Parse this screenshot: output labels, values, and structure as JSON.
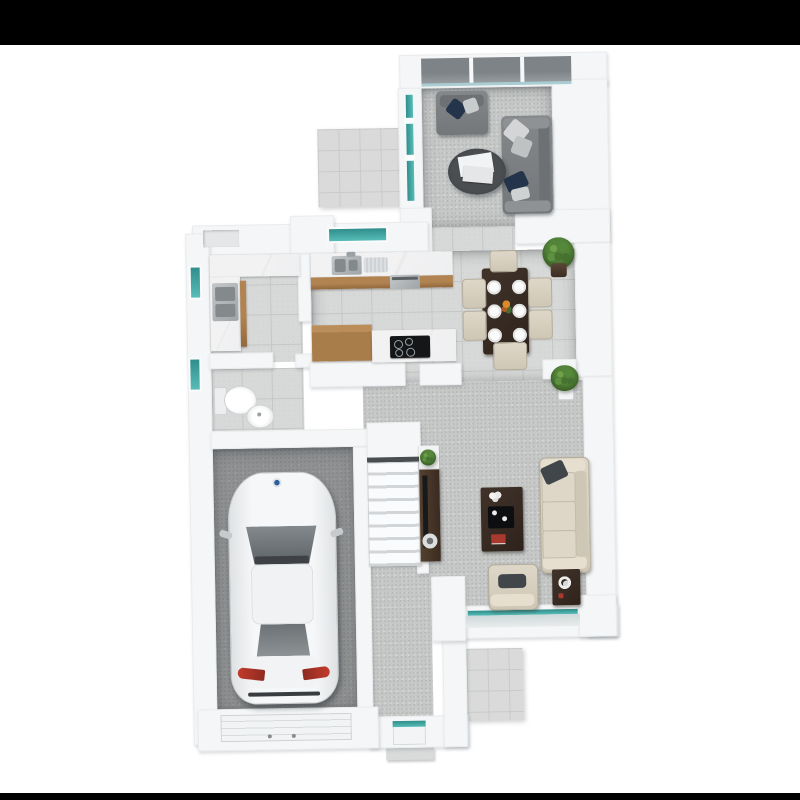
{
  "scene": {
    "type": "3d-floor-plan-render",
    "description": "Top-down dollhouse render of a house ground floor with garage, kitchen, dining, living and family rooms",
    "background": "#ffffff",
    "letterbox_bar_color": "#000000"
  },
  "palette": {
    "wall": "#f5f6f7",
    "wall_edge": "#e9ebec",
    "carpet": "#c6c8c7",
    "tile": "#d7d9d8",
    "paving": "#d9dad9",
    "garage_concrete": "#8f9192",
    "glazing_teal": "#3fa8a4",
    "bifold_glass": "#7e8387",
    "cabinet_wood": "#a0713f",
    "dark_wood": "#38291f",
    "marble": "#f0f0f1",
    "sofa_grey": "#7d8082",
    "cushion_navy": "#2b3b52",
    "cream_upholstery": "#d9d2c2",
    "plant_green": "#538439",
    "car_body": "#f3f4f5",
    "car_glass": "#71767b",
    "taillight": "#b13a2e",
    "hob_black": "#141618"
  },
  "rooms": [
    {
      "id": "living-room",
      "name": "Living room",
      "floor": "carpet",
      "furniture": [
        "grey armchair",
        "grey three-seat sofa",
        "round coffee table with books"
      ],
      "features": [
        "three-panel bifold glass doors",
        "glazed side screen"
      ]
    },
    {
      "id": "dining-area",
      "name": "Dining area",
      "floor": "tile",
      "furniture": [
        "dark wood dining table",
        "six cream chairs",
        "six place settings",
        "centrepiece"
      ],
      "features": [
        "two potted plants in wall nooks"
      ]
    },
    {
      "id": "kitchen",
      "name": "Kitchen",
      "floor": "tile",
      "furniture": [
        "marble worktop with double sink and drainer",
        "oven",
        "wood island unit",
        "induction hob"
      ],
      "features": [
        "window over sink",
        "rear lobby alcove"
      ]
    },
    {
      "id": "utility-room",
      "name": "Utility room",
      "floor": "tile",
      "furniture": [
        "L-shaped marble counter",
        "double stainless sink"
      ],
      "features": [
        "side window"
      ]
    },
    {
      "id": "wc",
      "name": "WC",
      "floor": "tile",
      "furniture": [
        "toilet",
        "round basin"
      ],
      "features": [
        "side window"
      ]
    },
    {
      "id": "garage",
      "name": "Garage",
      "floor": "concrete",
      "furniture": [
        "white car"
      ],
      "features": [
        "sectional garage door"
      ]
    },
    {
      "id": "hallway",
      "name": "Hallway",
      "floor": "carpet",
      "furniture": [
        "tv console with plant and speaker stool"
      ],
      "features": [
        "staircase",
        "front door with glazed panel",
        "entrance step"
      ]
    },
    {
      "id": "family-room",
      "name": "Family room",
      "floor": "carpet",
      "furniture": [
        "cream sofa",
        "dark coffee table with tray",
        "cream armchair",
        "dark side table with ornament"
      ],
      "features": [
        "full-width rear window"
      ]
    },
    {
      "id": "rear-patio",
      "name": "Rear patio",
      "floor": "paving",
      "furniture": [],
      "features": []
    },
    {
      "id": "front-patio",
      "name": "Front patio",
      "floor": "paving",
      "furniture": [],
      "features": []
    }
  ],
  "vehicle": {
    "type": "car",
    "color": "white",
    "badge_color": "#2b5f9e",
    "parked_in": "garage",
    "orientation": "nose up"
  }
}
